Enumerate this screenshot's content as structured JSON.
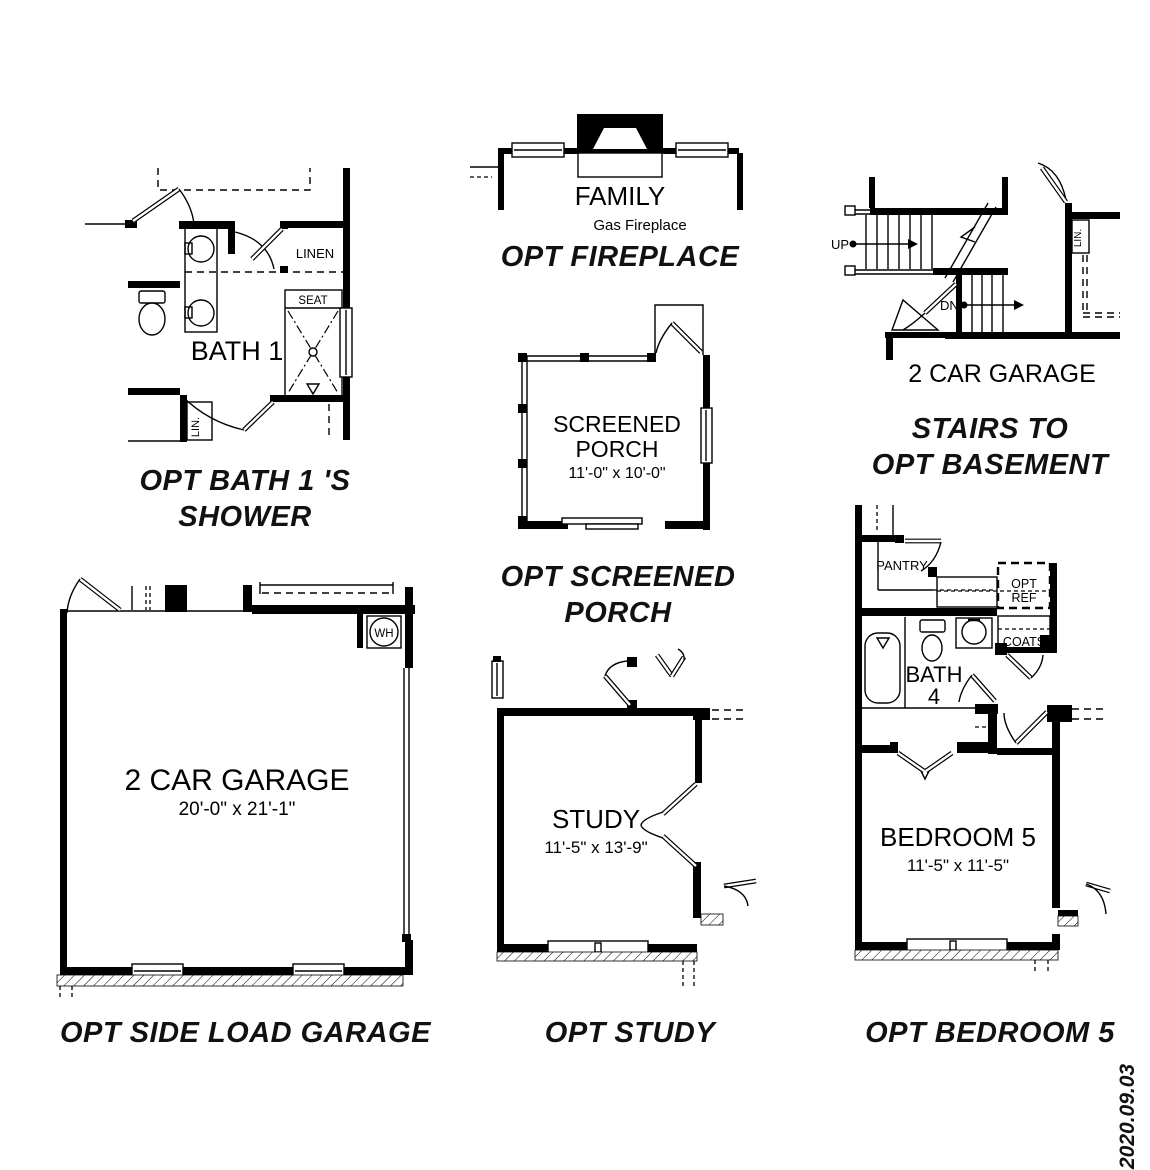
{
  "colors": {
    "ink": "#000000",
    "faint": "#c9c9c9"
  },
  "doc": {
    "date_stamp": "2020.09.03"
  },
  "bath1": {
    "room": "BATH 1",
    "linen": "LINEN",
    "seat": "SEAT",
    "lin": "LIN.",
    "caption1": "OPT BATH 1 'S",
    "caption2": "SHOWER"
  },
  "fireplace": {
    "room": "FAMILY",
    "faint": "Gas Fireplace",
    "caption": "OPT FIREPLACE"
  },
  "stairs": {
    "up": "UP",
    "dn": "DN",
    "lin": "LIN.",
    "garage_label": "2 CAR GARAGE",
    "caption1": "STAIRS TO",
    "caption2": "OPT BASEMENT"
  },
  "porch": {
    "room1": "SCREENED",
    "room2": "PORCH",
    "dims": "11'-0\" x 10'-0\"",
    "caption1": "OPT SCREENED",
    "caption2": "PORCH"
  },
  "garage": {
    "room": "2 CAR GARAGE",
    "dims": "20'-0\" x 21'-1\"",
    "wh": "WH",
    "caption": "OPT SIDE LOAD GARAGE"
  },
  "study": {
    "room": "STUDY",
    "dims": "11'-5\" x 13'-9\"",
    "caption": "OPT STUDY"
  },
  "bedroom5": {
    "pantry": "PANTRY",
    "opt_ref1": "OPT",
    "opt_ref2": "REF",
    "coats": "COATS",
    "bath_line1": "BATH",
    "bath_line2": "4",
    "room": "BEDROOM 5",
    "dims": "11'-5\" x 11'-5\"",
    "caption": "OPT BEDROOM 5"
  }
}
